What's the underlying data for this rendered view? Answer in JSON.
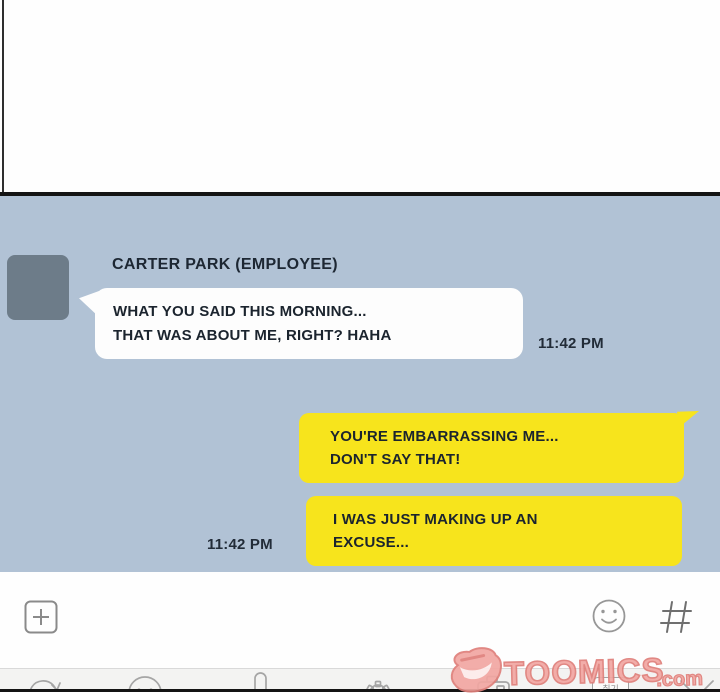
{
  "colors": {
    "chat_bg": "#b1c2d5",
    "bubble_yellow": "#f7e41c",
    "bubble_white": "#fdfdfd",
    "avatar_gray": "#6d7c89",
    "panel_border": "#141414",
    "text_dark": "#1b242e",
    "icon_gray": "#9a9a9a",
    "watermark_fill": "#f2a7a2",
    "watermark_stroke": "#df7f7a"
  },
  "chat": {
    "sender_name": "CARTER PARK (EMPLOYEE)",
    "messages": [
      {
        "side": "left",
        "line1": "WHAT YOU SAID THIS MORNING...",
        "line2": "THAT WAS ABOUT ME, RIGHT? HAHA",
        "timestamp": "11:42 PM"
      },
      {
        "side": "right",
        "line1": "YOU'RE EMBARRASSING ME...",
        "line2": "DON'T SAY THAT!"
      },
      {
        "side": "right",
        "line1": "I WAS JUST MAKING UP AN",
        "line2": "EXCUSE...",
        "timestamp": "11:42 PM"
      }
    ]
  },
  "composer": {
    "add_icon": "plus-in-box",
    "emoji_icon": "smiley-face",
    "hashtag_icon": "hash"
  },
  "toolbar": {
    "korean_button_label": "취기",
    "icons": [
      "undo-arrow",
      "smiley-face",
      "microphone",
      "settings-gear",
      "camera",
      "korean-button",
      "close-x"
    ]
  },
  "watermark": {
    "brand": "TOOMICS",
    "tld": ".com"
  }
}
